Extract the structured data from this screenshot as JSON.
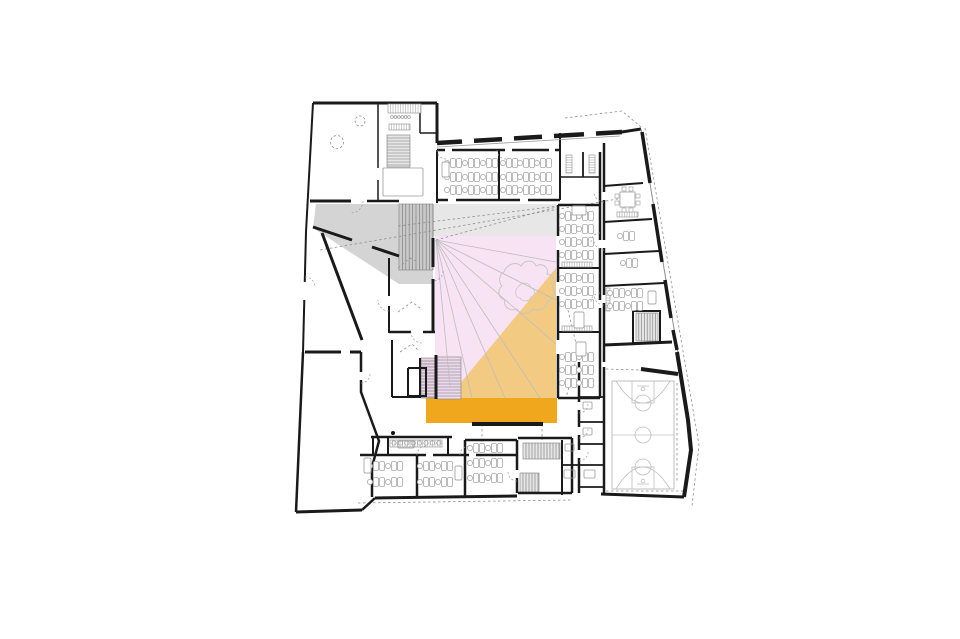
{
  "canvas": {
    "width": 960,
    "height": 639,
    "background": "#ffffff"
  },
  "palette": {
    "wall": "#1a1a1a",
    "thin": "#8f8f8f",
    "light": "#c6c6c6",
    "furniture": "#a9a9a9",
    "grayWedge": "#d2d2d2",
    "grayBand": "#e4e4e4",
    "pink": "#f7e3f4",
    "orange": "#f2c87b",
    "stageOrange": "#f0a71e",
    "court": "#bfbfbf",
    "white": "#ffffff"
  },
  "zones": [
    {
      "name": "zone-gray-ramp",
      "fill": "grayWedge",
      "opacity": 0.95,
      "points": "316,204 433,204 433,284 399,284 313,228"
    },
    {
      "name": "zone-gray-band",
      "fill": "grayBand",
      "opacity": 0.9,
      "points": "433,204 556,204 556,236 433,236"
    },
    {
      "name": "zone-atrium-pink",
      "fill": "pink",
      "opacity": 1,
      "points": "435,236 556,236 556,398 435,398"
    },
    {
      "name": "zone-orange-wedge",
      "fill": "orange",
      "opacity": 0.95,
      "points": "556,268 556,398 448,398"
    },
    {
      "name": "zone-stage",
      "fill": "stageOrange",
      "opacity": 1,
      "points": "426,398 557,398 557,423 426,423"
    },
    {
      "name": "zone-stage-sliver",
      "fill": "stageOrange",
      "opacity": 1,
      "points": "420,372 426,372 426,398 420,398"
    }
  ],
  "stairs": [
    {
      "name": "stair-main",
      "x": 399,
      "y": 204,
      "w": 34,
      "h": 66,
      "dir": "h",
      "fill": "#c9c9c9",
      "step": 3.4
    },
    {
      "name": "stair-nw",
      "x": 387,
      "y": 135,
      "w": 23,
      "h": 32,
      "dir": "v",
      "fill": "#e6e6e6",
      "step": 3
    },
    {
      "name": "stair-atrium",
      "x": 437,
      "y": 357,
      "w": 24,
      "h": 42,
      "dir": "v",
      "fill": "#ecd9ec",
      "step": 3
    },
    {
      "name": "stair-atrium-2",
      "x": 421,
      "y": 358,
      "w": 14,
      "h": 40,
      "dir": "v",
      "fill": "#e9d2e4",
      "step": 3
    },
    {
      "name": "stair-se-upper",
      "x": 523,
      "y": 443,
      "w": 37,
      "h": 16,
      "dir": "h",
      "fill": "#e6e6e6",
      "step": 3
    },
    {
      "name": "stair-se-lower",
      "x": 520,
      "y": 473,
      "w": 19,
      "h": 19,
      "dir": "h",
      "fill": "#e6e6e6",
      "step": 3
    },
    {
      "name": "stair-east",
      "x": 636,
      "y": 313,
      "w": 22,
      "h": 28,
      "dir": "h",
      "fill": "#e6e6e6",
      "step": 2.8
    }
  ],
  "sight": {
    "origin": [
      436,
      240
    ],
    "targets": [
      [
        556,
        262
      ],
      [
        556,
        300
      ],
      [
        556,
        344
      ],
      [
        540,
        398
      ],
      [
        505,
        398
      ],
      [
        472,
        398
      ],
      [
        450,
        386
      ]
    ]
  },
  "dashed": [
    {
      "name": "sightline-dashed-1",
      "p": "320,250 635,196"
    },
    {
      "name": "sightline-dashed-2",
      "p": "398,226 574,204"
    },
    {
      "name": "sightline-dashed-3",
      "p": "436,240 560,206"
    },
    {
      "name": "site-line-ne",
      "p": "565,118 622,111 641,127"
    },
    {
      "name": "site-line-east",
      "p": "645,128 699,445 692,506"
    },
    {
      "name": "site-line-south",
      "p": "358,503 572,500"
    },
    {
      "name": "corridor-dash-1",
      "p": "482,424 482,449"
    },
    {
      "name": "corridor-dash-2",
      "p": "542,424 542,440"
    },
    {
      "name": "court-room-dash-top",
      "p": "606,369 640,370"
    },
    {
      "name": "court-room-dash-bottom",
      "p": "606,491 683,491"
    },
    {
      "name": "court-room-dash-right",
      "p": "677,383 677,483"
    },
    {
      "name": "path-curve",
      "p": "568,310 578,352 566,398"
    },
    {
      "name": "plant-sketch-1",
      "p": "398,268 410,258 418,262"
    },
    {
      "name": "plant-sketch-2",
      "p": "398,312 412,302 420,308"
    },
    {
      "name": "plant-sketch-3",
      "p": "400,352 412,344 418,350"
    }
  ],
  "tree": {
    "outer": "M504,272 c3,-8 12,-11 17,-6 c4,-7 13,-6 15,0 c7,-4 13,2 11,8 c7,1 9,8 5,13 c5,5 2,13 -5,14 c0,7 -8,11 -14,8 c-4,6 -13,6 -16,0 c-8,3 -14,-3 -12,-9 c-7,-2 -8,-10 -3,-14 c-5,-6 -1,-13 2,-14 z",
    "inner": "M519,286 c4,-5 11,-3 12,2 c5,1 4,8 0,9 c-1,5 -9,5 -11,1 c-5,0 -6,-8 -1,-12 z"
  },
  "walls": [
    [
      "wall-nw-top",
      3,
      "313,103 437,103"
    ],
    [
      "wall-nw-step",
      3,
      "437,103 437,143"
    ],
    [
      "wall-north-facade",
      4.5,
      "437,143 622,132"
    ],
    [
      "wall-ne-corner",
      3,
      "622,132 641,129"
    ],
    [
      "wall-east-facade-line",
      1,
      "641,129 678,353",
      "#8f8f8f"
    ],
    [
      "wall-east-b1",
      3.5,
      "642,132 650,183"
    ],
    [
      "wall-east-b2",
      3.5,
      "653,204 662,262"
    ],
    [
      "wall-east-b3",
      3.5,
      "665,280 671,318"
    ],
    [
      "wall-east-b4",
      3.5,
      "673,330 677,350"
    ],
    [
      "wall-east-low",
      4,
      "677,352 688,420 691,450 684,497"
    ],
    [
      "wall-south-court",
      3,
      "684,497 601,494"
    ],
    [
      "wall-south-stair",
      2.5,
      "572,493 518,493"
    ],
    [
      "wall-south-rooms",
      3,
      "517,496 375,498"
    ],
    [
      "wall-sw-chamfer",
      2.5,
      "375,498 362,510"
    ],
    [
      "wall-south-hall",
      3,
      "362,510 296,512"
    ],
    [
      "wall-west-hall",
      2.5,
      "296,512 303,352"
    ],
    [
      "wall-west-mid",
      2,
      "303,352 306,232"
    ],
    [
      "wall-west-nw",
      2,
      "306,232 313,103"
    ],
    [
      "wall-nw-bottom-a",
      3,
      "310,201 351,201"
    ],
    [
      "wall-nw-bottom-b",
      2.5,
      "367,201 399,201"
    ],
    [
      "wall-nw-div",
      1.5,
      "378,103 378,168"
    ],
    [
      "wall-nw-div-2",
      1.5,
      "378,180 378,201"
    ],
    [
      "wall-nw-closet-v",
      1.5,
      "420,103 420,133"
    ],
    [
      "wall-nw-closet-h",
      1.5,
      "420,133 437,133"
    ],
    [
      "wall-atrium-west-a",
      3,
      "433,238 433,267"
    ],
    [
      "wall-atrium-west-b",
      3,
      "433,279 433,333"
    ],
    [
      "wall-top-rooms-top",
      2.5,
      "437,150 560,150"
    ],
    [
      "wall-top-rooms-divider",
      2,
      "499,150 499,200"
    ],
    [
      "wall-room-a-west",
      2,
      "437,150 437,203"
    ],
    [
      "wall-top-rooms-bottom",
      2.5,
      "437,200 560,200"
    ],
    [
      "wall-room-c-west",
      2,
      "560,133 560,200"
    ],
    [
      "wall-room-c-divider",
      1.8,
      "583,152 583,177"
    ],
    [
      "wall-room-c-split",
      1.5,
      "560,177 600,177"
    ],
    [
      "wall-rw-top",
      2.5,
      "558,205 600,205"
    ],
    [
      "wall-rw-east",
      2.5,
      "600,152 600,398"
    ],
    [
      "wall-rw-west-a",
      2.5,
      "558,205 558,236"
    ],
    [
      "wall-rw-west-b",
      2.5,
      "558,250 558,282"
    ],
    [
      "wall-rw-west-c",
      2.5,
      "558,296 558,340"
    ],
    [
      "wall-rw-west-d",
      2.5,
      "558,354 558,398"
    ],
    [
      "wall-rw-div-1",
      2,
      "558,268 600,268"
    ],
    [
      "wall-rw-div-2",
      2,
      "558,332 600,332"
    ],
    [
      "wall-rw-bottom",
      2.5,
      "558,398 600,398"
    ],
    [
      "wall-wedge-west",
      2.5,
      "604,143 604,362"
    ],
    [
      "wall-wedge-d1",
      2,
      "604,186 643,183"
    ],
    [
      "wall-wedge-d2",
      2,
      "604,222 652,219"
    ],
    [
      "wall-wedge-d3",
      2,
      "604,254 659,251"
    ],
    [
      "wall-wedge-d4",
      2,
      "604,286 664,283"
    ],
    [
      "wall-stair-e-box",
      2,
      "633,311 660,311 660,343 633,343 633,311"
    ],
    [
      "wall-wedge-bottom",
      3,
      "604,345 672,342"
    ],
    [
      "wall-court-top",
      4,
      "641,369 678,374"
    ],
    [
      "wall-strip-west",
      2.5,
      "579,362 579,493"
    ],
    [
      "wall-strip-east",
      2.5,
      "604,367 604,493"
    ],
    [
      "wall-strip-d1",
      1.8,
      "579,397 604,397"
    ],
    [
      "wall-strip-d2",
      1.8,
      "579,422 604,422"
    ],
    [
      "wall-strip-d3",
      1.8,
      "579,444 604,444"
    ],
    [
      "wall-strip-d4",
      1.8,
      "579,465 604,465"
    ],
    [
      "wall-strip-d5",
      1.8,
      "579,487 604,487"
    ],
    [
      "wall-sub-stage",
      4,
      "472,424 543,424"
    ],
    [
      "wall-small-room-w",
      2,
      "562,440 562,495"
    ],
    [
      "wall-small-room-d",
      1.8,
      "562,465 579,465"
    ],
    [
      "wall-band-top",
      2.5,
      "371,437 452,437"
    ],
    [
      "wall-band-w1",
      2,
      "388,437 388,455"
    ],
    [
      "wall-band-w2",
      2,
      "448,437 448,455"
    ],
    [
      "wall-band-w3",
      2,
      "373,437 373,455"
    ],
    [
      "wall-rooms-top",
      2.5,
      "360,455 517,455"
    ],
    [
      "wall-rooms-d1",
      2.5,
      "417,455 417,497"
    ],
    [
      "wall-rooms-d2",
      2.5,
      "465,440 465,497"
    ],
    [
      "wall-rooms-d3",
      2.5,
      "517,440 517,493"
    ],
    [
      "wall-room-c2-top",
      2.5,
      "465,440 517,440"
    ],
    [
      "wall-se-stair-top",
      2.5,
      "518,438 572,438"
    ],
    [
      "wall-se-stair-east",
      2.5,
      "572,438 572,493"
    ],
    [
      "wall-hall-top-a",
      3,
      "305,352 341,352"
    ],
    [
      "wall-hall-top-b",
      3,
      "350,352 361,352"
    ],
    [
      "wall-hall-right",
      2.5,
      "361,352 361,392 379,441 372,467 372,497"
    ],
    [
      "wall-diag-main",
      3,
      "322,233 362,340"
    ],
    [
      "wall-diag-gray-a",
      3,
      "313,227 352,240"
    ],
    [
      "wall-diag-gray-b",
      3,
      "372,247 399,256"
    ],
    [
      "wall-sr-v1a",
      2,
      "389,258 389,296"
    ],
    [
      "wall-sr-v1b",
      2,
      "389,306 389,333"
    ],
    [
      "wall-sr-h1",
      2.5,
      "389,332 411,332"
    ],
    [
      "wall-sr-h2",
      2.5,
      "423,332 435,332"
    ],
    [
      "wall-sr-v2",
      2,
      "392,340 392,397"
    ],
    [
      "wall-sr-bottom",
      2,
      "392,397 421,397"
    ],
    [
      "wall-sr-box",
      2,
      "408,368 426,368 426,396 408,396 408,368"
    ],
    [
      "wall-ast-left",
      3,
      "436,355 436,399"
    ],
    [
      "wall-ast-left-2",
      2,
      "420,358 420,398"
    ],
    [
      "sill-north",
      0.8,
      "437,147 620,136",
      "#9a9a9a"
    ]
  ],
  "gaps": [
    [
      "gap-top-a",
      4,
      "445,150 452,150"
    ],
    [
      "gap-top-b",
      4,
      "505,150 512,150"
    ],
    [
      "gap-top-c",
      4,
      "549,150 555,150"
    ],
    [
      "gap-win-1",
      6,
      "462,141.4 474,140.7"
    ],
    [
      "gap-win-2",
      6,
      "502,139.1 514,138.4"
    ],
    [
      "gap-win-3",
      6,
      "542,136.8 554,136.1"
    ],
    [
      "gap-win-4",
      6,
      "584,134.4 596,133.7"
    ],
    [
      "gap-bot-a",
      4,
      "448,200 456,200"
    ],
    [
      "gap-bot-b",
      4,
      "520,200 528,200"
    ],
    [
      "gap-wedge-1",
      4,
      "604,192 604,200"
    ],
    [
      "gap-wedge-2",
      4,
      "604,240 604,248"
    ],
    [
      "gap-wedge-3",
      4,
      "604,295 604,303"
    ],
    [
      "gap-strip-1",
      4,
      "579,402 579,410"
    ],
    [
      "gap-strip-2",
      4,
      "579,427 579,435"
    ],
    [
      "gap-strip-3",
      4,
      "579,450 579,458"
    ],
    [
      "gap-hall",
      4,
      "361,372 361,380"
    ],
    [
      "gap-se",
      4,
      "517,470 517,478"
    ],
    [
      "gap-rwe-1",
      4,
      "600,240 600,248"
    ],
    [
      "gap-rwe-2",
      4,
      "600,300 600,308"
    ],
    [
      "gap-rooms-1",
      4,
      "426,455 433,455"
    ],
    [
      "gap-rooms-2",
      4,
      "469,455 476,455"
    ],
    [
      "gap-west",
      3.5,
      "304,300 305,282"
    ]
  ],
  "shelves": [
    {
      "name": "shelf-nw-1",
      "x": 388,
      "y": 104,
      "w": 33,
      "h": 9
    },
    {
      "name": "shelf-nw-2",
      "x": 389,
      "y": 124,
      "w": 21,
      "h": 6
    },
    {
      "name": "shelf-wc-1",
      "x": 566,
      "y": 155,
      "w": 6,
      "h": 18
    },
    {
      "name": "shelf-wc-2",
      "x": 589,
      "y": 155,
      "w": 6,
      "h": 18
    },
    {
      "name": "shelf-rw-1",
      "x": 562,
      "y": 262,
      "w": 30,
      "h": 5
    },
    {
      "name": "shelf-rw-2",
      "x": 562,
      "y": 326,
      "w": 30,
      "h": 5
    },
    {
      "name": "shelf-wedge",
      "x": 606,
      "y": 288,
      "w": 4,
      "h": 23
    },
    {
      "name": "sideboard-wedge",
      "x": 617,
      "y": 212,
      "w": 21,
      "h": 5
    },
    {
      "name": "shelf-band",
      "x": 390,
      "y": 440,
      "w": 52,
      "h": 7
    }
  ],
  "fixtures": [
    {
      "name": "fixture-strip-1",
      "x": 583,
      "y": 402,
      "w": 9,
      "h": 7
    },
    {
      "name": "fixture-strip-2",
      "x": 583,
      "y": 428,
      "w": 9,
      "h": 7
    },
    {
      "name": "fixture-strip-3",
      "x": 584,
      "y": 470,
      "w": 11,
      "h": 8
    },
    {
      "name": "fixture-small-1",
      "x": 564,
      "y": 470,
      "w": 11,
      "h": 8
    },
    {
      "name": "fixture-small-2",
      "x": 565,
      "y": 444,
      "w": 9,
      "h": 7
    },
    {
      "name": "nw-stair-landing",
      "x": 383,
      "y": 168,
      "w": 40,
      "h": 28
    },
    {
      "name": "fixture-band",
      "x": 398,
      "y": 441,
      "w": 16,
      "h": 7
    }
  ],
  "desks": [
    [
      455,
      163
    ],
    [
      473,
      163
    ],
    [
      491,
      163
    ],
    [
      455,
      177
    ],
    [
      473,
      177
    ],
    [
      491,
      177
    ],
    [
      455,
      190
    ],
    [
      473,
      190
    ],
    [
      491,
      190
    ],
    [
      511,
      163
    ],
    [
      528,
      163
    ],
    [
      545,
      163
    ],
    [
      511,
      177
    ],
    [
      528,
      177
    ],
    [
      545,
      177
    ],
    [
      511,
      190
    ],
    [
      528,
      190
    ],
    [
      545,
      190
    ],
    [
      570,
      216
    ],
    [
      587,
      216
    ],
    [
      570,
      229
    ],
    [
      587,
      229
    ],
    [
      570,
      242
    ],
    [
      587,
      242
    ],
    [
      570,
      255
    ],
    [
      587,
      255
    ],
    [
      570,
      278
    ],
    [
      587,
      278
    ],
    [
      570,
      291
    ],
    [
      587,
      291
    ],
    [
      570,
      304
    ],
    [
      587,
      304
    ],
    [
      570,
      357
    ],
    [
      587,
      357
    ],
    [
      570,
      370
    ],
    [
      587,
      370
    ],
    [
      570,
      383
    ],
    [
      587,
      383
    ],
    [
      378,
      466
    ],
    [
      396,
      466
    ],
    [
      378,
      482
    ],
    [
      396,
      482
    ],
    [
      428,
      466
    ],
    [
      446,
      466
    ],
    [
      428,
      482
    ],
    [
      446,
      482
    ],
    [
      478,
      448
    ],
    [
      496,
      448
    ],
    [
      478,
      463
    ],
    [
      496,
      463
    ],
    [
      478,
      478
    ],
    [
      496,
      478
    ],
    [
      628,
      236
    ],
    [
      631,
      263
    ],
    [
      618,
      293
    ],
    [
      636,
      293
    ],
    [
      618,
      306
    ],
    [
      636,
      306
    ]
  ],
  "teachers": [
    {
      "x": 442,
      "y": 162,
      "w": 7,
      "h": 15
    },
    {
      "x": 572,
      "y": 206,
      "w": 14,
      "h": 9
    },
    {
      "x": 574,
      "y": 312,
      "w": 10,
      "h": 16
    },
    {
      "x": 576,
      "y": 342,
      "w": 10,
      "h": 14
    },
    {
      "x": 364,
      "y": 458,
      "w": 7,
      "h": 15
    },
    {
      "x": 455,
      "y": 466,
      "w": 7,
      "h": 14
    },
    {
      "x": 648,
      "y": 291,
      "w": 8,
      "h": 13
    }
  ],
  "meeting": {
    "x": 620,
    "y": 192,
    "s": 15
  },
  "court": {
    "x": 612,
    "y": 381,
    "w": 62,
    "h": 108
  },
  "arcs": [
    [
      351,
      201,
      12,
      0,
      90
    ],
    [
      305,
      287,
      10,
      -90,
      0
    ],
    [
      389,
      300,
      11,
      90,
      180
    ],
    [
      422,
      332,
      11,
      90,
      180
    ],
    [
      604,
      192,
      10,
      90,
      180
    ],
    [
      604,
      240,
      10,
      90,
      180
    ],
    [
      604,
      295,
      10,
      90,
      180
    ],
    [
      579,
      404,
      9,
      0,
      90
    ],
    [
      579,
      429,
      9,
      0,
      90
    ],
    [
      579,
      452,
      9,
      0,
      90
    ],
    [
      446,
      150,
      9,
      90,
      180
    ],
    [
      506,
      150,
      9,
      90,
      180
    ],
    [
      433,
      271,
      10,
      0,
      90
    ],
    [
      426,
      455,
      9,
      180,
      270
    ],
    [
      469,
      455,
      9,
      180,
      270
    ],
    [
      517,
      472,
      9,
      90,
      180
    ],
    [
      361,
      374,
      9,
      0,
      90
    ],
    [
      600,
      242,
      9,
      180,
      270
    ],
    [
      600,
      302,
      9,
      180,
      270
    ]
  ],
  "dashedCircles": [
    [
      360,
      121,
      5
    ],
    [
      337,
      142,
      6.5
    ]
  ],
  "circleRows": [
    {
      "x": 394,
      "y": 443,
      "n": 8,
      "dx": 6.4,
      "r": 2.2
    },
    {
      "x": 392,
      "y": 117,
      "n": 6,
      "dx": 3.4,
      "r": 1.4
    }
  ],
  "dots": [
    [
      393,
      433,
      2
    ]
  ]
}
